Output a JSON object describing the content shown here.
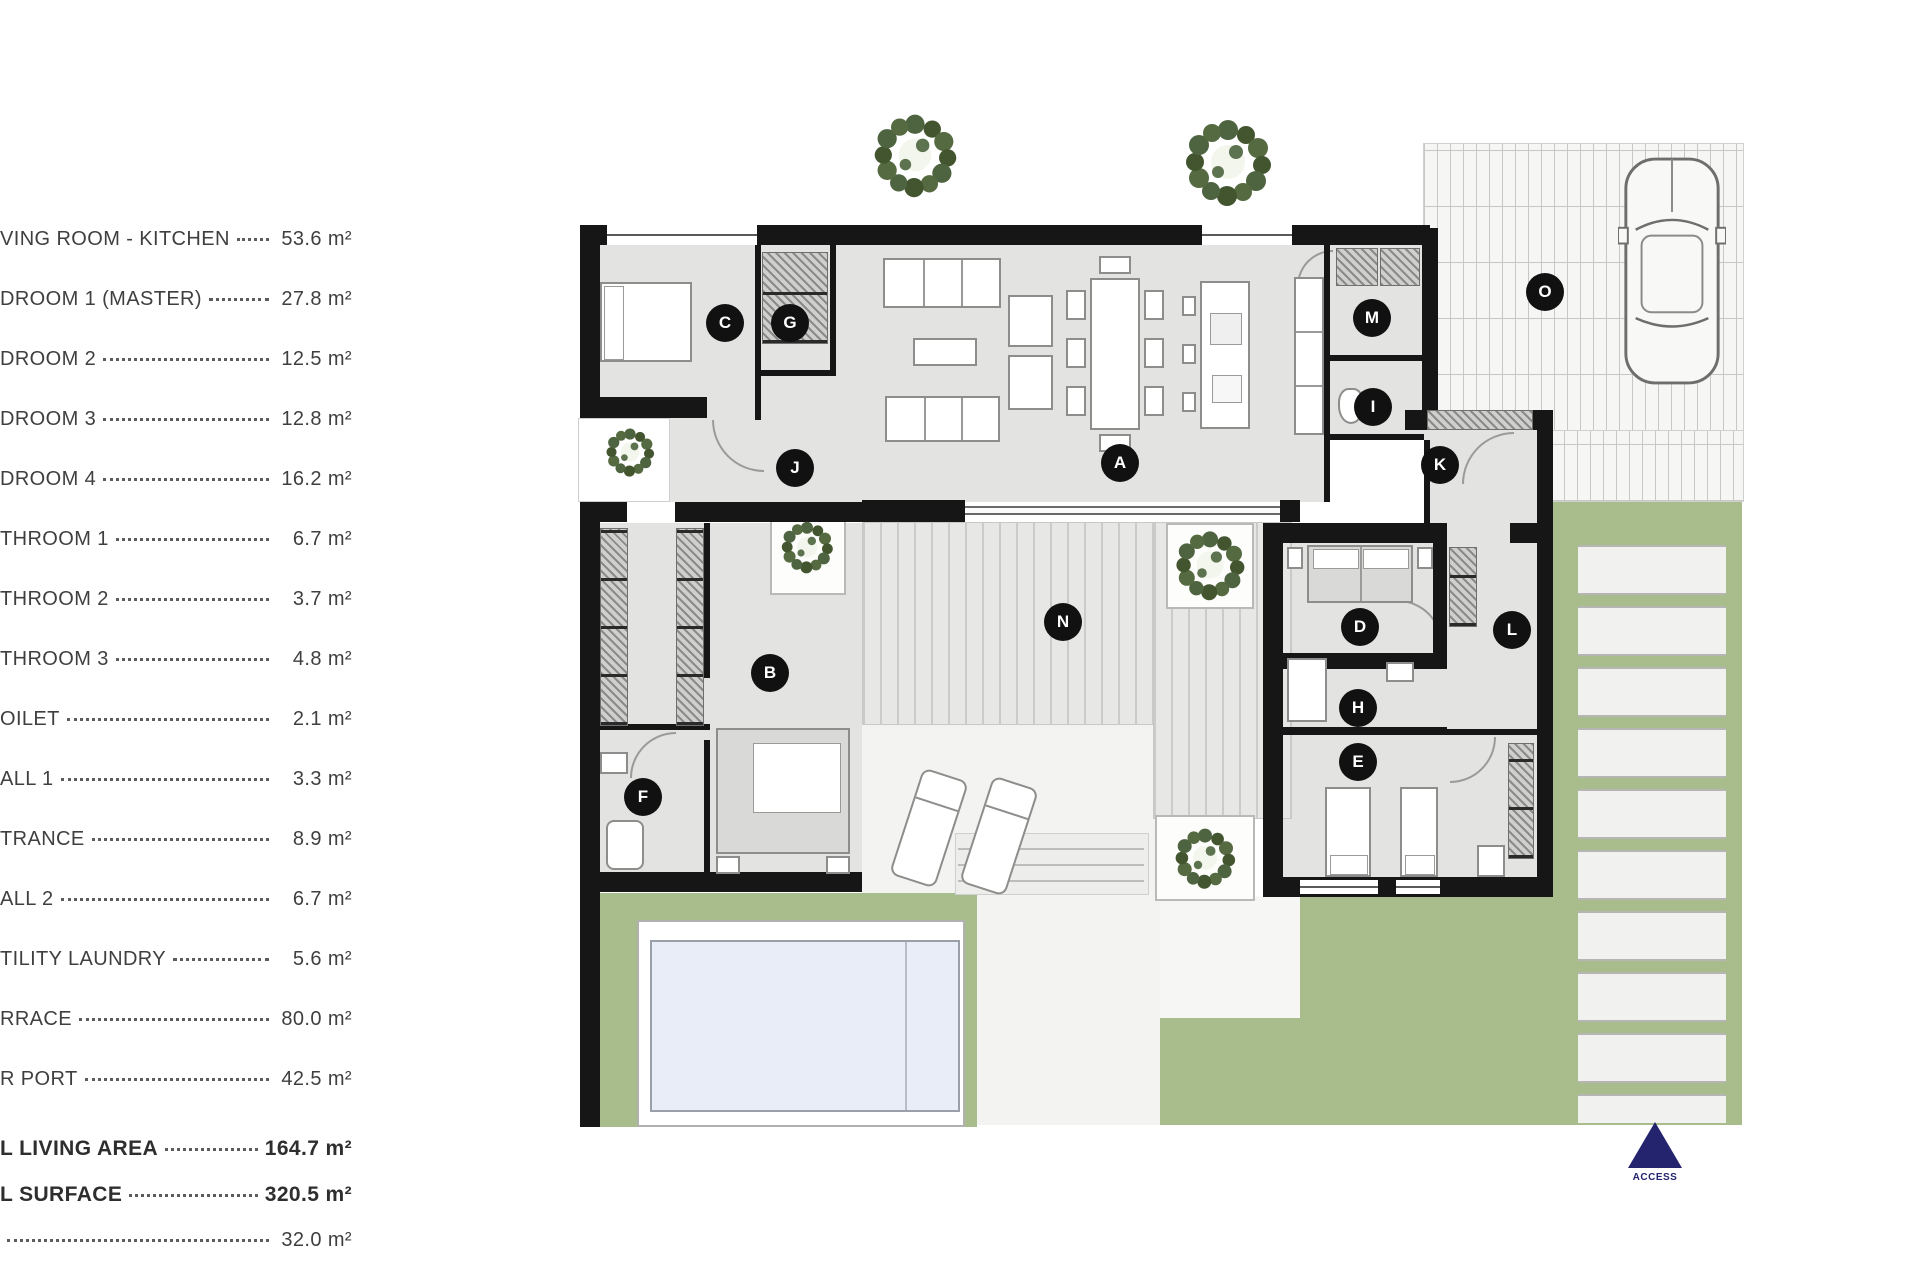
{
  "legend": {
    "items": [
      {
        "label": "VING ROOM - KITCHEN",
        "value": "53.6 m²"
      },
      {
        "label": "DROOM 1 (MASTER)",
        "value": "27.8 m²"
      },
      {
        "label": "DROOM 2",
        "value": "12.5 m²"
      },
      {
        "label": "DROOM 3",
        "value": "12.8 m²"
      },
      {
        "label": "DROOM 4",
        "value": "16.2 m²"
      },
      {
        "label": "THROOM 1",
        "value": "6.7 m²"
      },
      {
        "label": "THROOM 2",
        "value": "3.7 m²"
      },
      {
        "label": "THROOM 3",
        "value": "4.8 m²"
      },
      {
        "label": "OILET",
        "value": "2.1 m²"
      },
      {
        "label": "ALL 1",
        "value": "3.3 m²"
      },
      {
        "label": "TRANCE",
        "value": "8.9 m²"
      },
      {
        "label": "ALL 2",
        "value": "6.7 m²"
      },
      {
        "label": "TILITY LAUNDRY",
        "value": "5.6 m²"
      },
      {
        "label": "RRACE",
        "value": "80.0 m²"
      },
      {
        "label": "R PORT",
        "value": "42.5 m²"
      }
    ],
    "totals": [
      {
        "label": "L LIVING AREA",
        "value": "164.7 m²"
      },
      {
        "label": "L SURFACE",
        "value": "320.5 m²"
      },
      {
        "label": "",
        "value": "32.0 m²"
      }
    ]
  },
  "plan": {
    "markers": [
      {
        "letter": "A"
      },
      {
        "letter": "B"
      },
      {
        "letter": "C"
      },
      {
        "letter": "D"
      },
      {
        "letter": "E"
      },
      {
        "letter": "F"
      },
      {
        "letter": "G"
      },
      {
        "letter": "H"
      },
      {
        "letter": "I"
      },
      {
        "letter": "J"
      },
      {
        "letter": "K"
      },
      {
        "letter": "L"
      },
      {
        "letter": "M"
      },
      {
        "letter": "N"
      },
      {
        "letter": "O"
      }
    ],
    "access_label": "ACCESS",
    "colors": {
      "garden": "#a9bd8c",
      "pool_water": "#e9edf8",
      "wall": "#161616",
      "marker": "#111111",
      "access": "#23236e",
      "legend_text": "#3f3f3f"
    }
  }
}
